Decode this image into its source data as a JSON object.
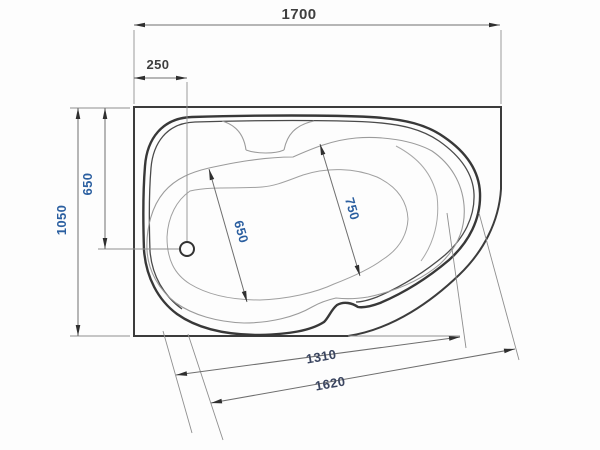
{
  "figure": {
    "title": "Corner bathtub plan-view technical drawing with dimensions",
    "units": "mm",
    "canvas": {
      "width": 600,
      "height": 450
    },
    "colors": {
      "outline_dark": "#3c3c3c",
      "outline_mid": "#4a4a4a",
      "contour_light": "#9b9b9b",
      "dim_line": "#6e6e6e",
      "ext_line": "#8f8f8f",
      "arrow": "#2f2f2f",
      "text_dark": "#3f3f3f",
      "text_blue": "#2b5fa0",
      "text_slate": "#3a4560"
    }
  },
  "dimensions_mm": {
    "overall_length": 1700,
    "overall_width": 1050,
    "drain_offset_from_left": 250,
    "drain_offset_from_top": 650,
    "basin_width": 650,
    "basin_length": 750,
    "basin_diagonal_length": 1310,
    "rim_diagonal_length": 1620
  },
  "dimensions": [
    {
      "id": "dimension-1700",
      "label": "1700",
      "color": "text_dark",
      "x1": 134,
      "y1": 25,
      "x2": 500,
      "y2": 25,
      "lx": 299,
      "ly": 19,
      "rot": 0,
      "size": 15
    },
    {
      "id": "dimension-250",
      "label": "250",
      "color": "text_dark",
      "x1": 134,
      "y1": 78,
      "x2": 187,
      "y2": 78,
      "lx": 158,
      "ly": 69,
      "rot": 0,
      "size": 13
    },
    {
      "id": "dimension-1050",
      "label": "1050",
      "color": "text_blue",
      "x1": 78,
      "y1": 108,
      "x2": 78,
      "y2": 336,
      "lx": 66,
      "ly": 220,
      "rot": -90,
      "size": 13
    },
    {
      "id": "dimension-650-left",
      "label": "650",
      "color": "text_blue",
      "x1": 105,
      "y1": 108,
      "x2": 105,
      "y2": 249,
      "lx": 92,
      "ly": 184,
      "rot": -90,
      "size": 13
    },
    {
      "id": "dimension-650-basin",
      "label": "650",
      "color": "text_blue",
      "x1": 209,
      "y1": 169,
      "x2": 247,
      "y2": 302,
      "lx": 237,
      "ly": 233,
      "rot": 74,
      "size": 13
    },
    {
      "id": "dimension-750",
      "label": "750",
      "color": "text_blue",
      "x1": 320,
      "y1": 144,
      "x2": 360,
      "y2": 276,
      "lx": 348,
      "ly": 210,
      "rot": 74,
      "size": 13
    },
    {
      "id": "dimension-1310",
      "label": "1310",
      "color": "text_slate",
      "x1": 176,
      "y1": 375,
      "x2": 460,
      "y2": 337,
      "lx": 322,
      "ly": 361,
      "rot": -10,
      "size": 13
    },
    {
      "id": "dimension-1620",
      "label": "1620",
      "color": "text_slate",
      "x1": 211,
      "y1": 403,
      "x2": 515,
      "y2": 349,
      "lx": 331,
      "ly": 388,
      "rot": -10,
      "size": 13
    }
  ],
  "extension_lines": [
    {
      "x1": 134,
      "y1": 30,
      "x2": 134,
      "y2": 104
    },
    {
      "x1": 501,
      "y1": 30,
      "x2": 501,
      "y2": 104
    },
    {
      "x1": 187,
      "y1": 82,
      "x2": 187,
      "y2": 241
    },
    {
      "x1": 70,
      "y1": 108,
      "x2": 130,
      "y2": 108
    },
    {
      "x1": 70,
      "y1": 336,
      "x2": 130,
      "y2": 336
    },
    {
      "x1": 98,
      "y1": 249,
      "x2": 179,
      "y2": 249
    },
    {
      "x1": 163,
      "y1": 331,
      "x2": 192,
      "y2": 433
    },
    {
      "x1": 188,
      "y1": 334,
      "x2": 223,
      "y2": 440
    },
    {
      "x1": 447,
      "y1": 213,
      "x2": 466,
      "y2": 348
    },
    {
      "x1": 479,
      "y1": 213,
      "x2": 519,
      "y2": 360
    },
    {
      "x1": 348,
      "y1": 336,
      "x2": 460,
      "y2": 336
    }
  ],
  "drain": {
    "cx": 187,
    "cy": 249,
    "r": 7
  }
}
